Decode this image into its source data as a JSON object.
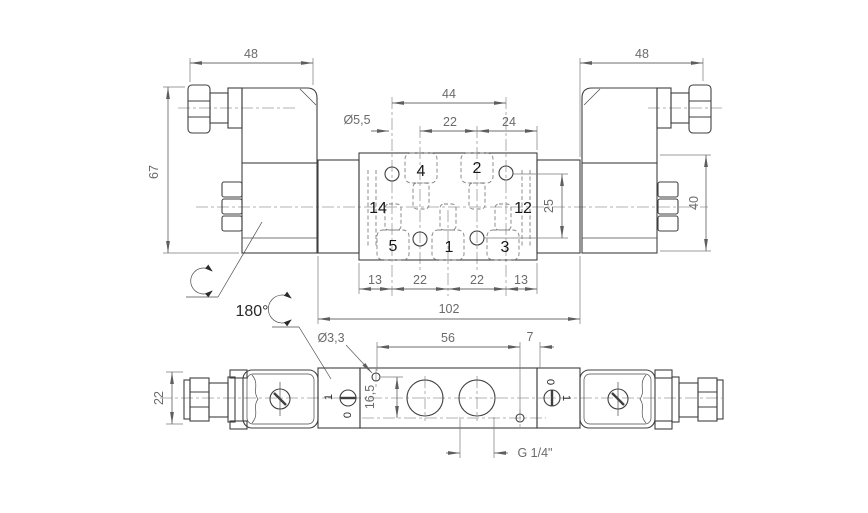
{
  "top_view": {
    "dim_48_left": "48",
    "dim_48_right": "48",
    "dim_67": "67",
    "dim_40": "40",
    "dim_44": "44",
    "dim_22_top": "22",
    "dim_24": "24",
    "dim_hole": "Ø5,5",
    "dim_25": "25",
    "dim_13_left": "13",
    "dim_22_bottom_left": "22",
    "dim_22_bottom_right": "22",
    "dim_13_right": "13",
    "dim_102": "102",
    "port_4": "4",
    "port_2": "2",
    "port_14": "14",
    "port_12": "12",
    "port_5": "5",
    "port_1": "1",
    "port_3": "3"
  },
  "bottom_view": {
    "rotation": "180°",
    "dim_hole": "Ø3,3",
    "dim_56": "56",
    "dim_7": "7",
    "dim_16_5": "16,5",
    "dim_22": "22",
    "thread": "G 1/4\"",
    "override_left_on": "1",
    "override_left_off": "0",
    "override_right_off": "0",
    "override_right_on": "1"
  }
}
